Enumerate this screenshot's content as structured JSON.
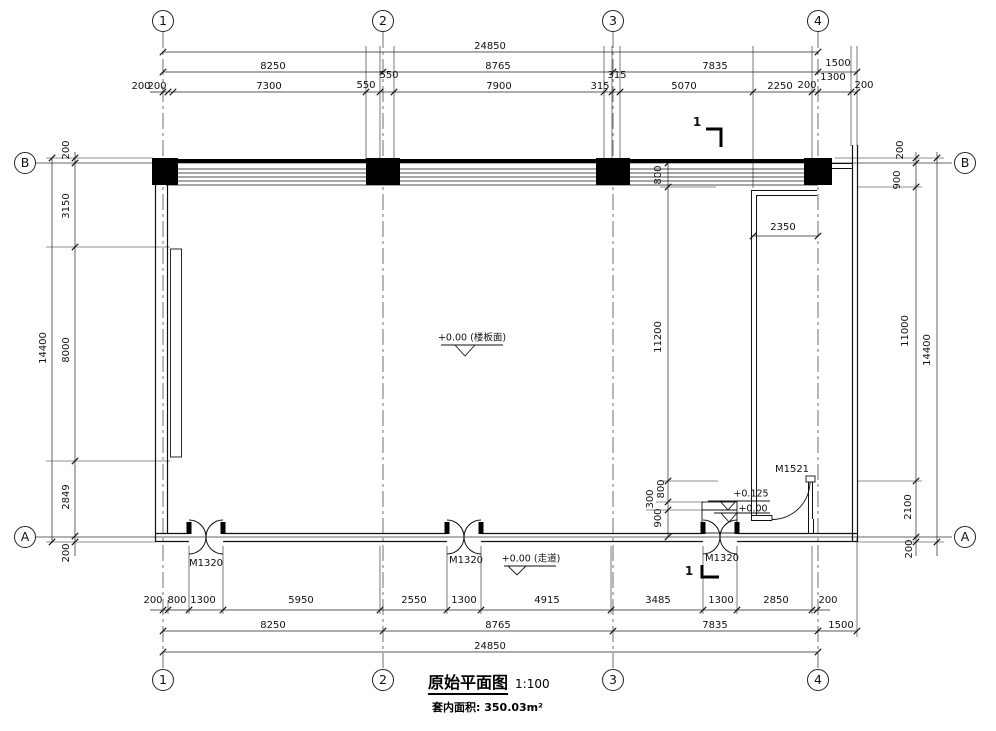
{
  "page": {
    "title": "原始平面图",
    "scale": "1:100",
    "area_note": "套内面积: 350.03m²"
  },
  "grid_bubbles": [
    {
      "label": "1",
      "x": 163,
      "y": 21
    },
    {
      "label": "2",
      "x": 383,
      "y": 21
    },
    {
      "label": "3",
      "x": 613,
      "y": 21
    },
    {
      "label": "4",
      "x": 818,
      "y": 21
    },
    {
      "label": "1",
      "x": 163,
      "y": 680
    },
    {
      "label": "2",
      "x": 383,
      "y": 680
    },
    {
      "label": "3",
      "x": 613,
      "y": 680
    },
    {
      "label": "4",
      "x": 818,
      "y": 680
    },
    {
      "label": "B",
      "x": 25,
      "y": 163
    },
    {
      "label": "A",
      "x": 25,
      "y": 537
    },
    {
      "label": "B",
      "x": 965,
      "y": 163
    },
    {
      "label": "A",
      "x": 965,
      "y": 537
    }
  ],
  "labels": [
    {
      "name": "dim-label",
      "text": "24850",
      "x": 490,
      "y": 47
    },
    {
      "name": "dim-label",
      "text": "8250",
      "x": 273,
      "y": 67
    },
    {
      "name": "dim-label",
      "text": "8765",
      "x": 498,
      "y": 67
    },
    {
      "name": "dim-label",
      "text": "7835",
      "x": 715,
      "y": 67
    },
    {
      "name": "dim-label",
      "text": "1500",
      "x": 838,
      "y": 64
    },
    {
      "name": "dim-label",
      "text": "1300",
      "x": 833,
      "y": 78
    },
    {
      "name": "dim-label",
      "text": "200",
      "x": 141,
      "y": 87
    },
    {
      "name": "dim-label",
      "text": "200",
      "x": 157,
      "y": 87
    },
    {
      "name": "dim-label",
      "text": "7300",
      "x": 269,
      "y": 87
    },
    {
      "name": "dim-label",
      "text": "550",
      "x": 366,
      "y": 86
    },
    {
      "name": "dim-label",
      "text": "550",
      "x": 389,
      "y": 76
    },
    {
      "name": "dim-label",
      "text": "7900",
      "x": 499,
      "y": 87
    },
    {
      "name": "dim-label",
      "text": "315",
      "x": 600,
      "y": 87
    },
    {
      "name": "dim-label",
      "text": "315",
      "x": 617,
      "y": 76
    },
    {
      "name": "dim-label",
      "text": "5070",
      "x": 684,
      "y": 87
    },
    {
      "name": "dim-label",
      "text": "2250",
      "x": 780,
      "y": 87
    },
    {
      "name": "dim-label",
      "text": "200",
      "x": 807,
      "y": 86
    },
    {
      "name": "dim-label",
      "text": "200",
      "x": 864,
      "y": 86
    },
    {
      "name": "dim-label",
      "text": "200",
      "x": 153,
      "y": 601
    },
    {
      "name": "dim-label",
      "text": "800",
      "x": 177,
      "y": 601
    },
    {
      "name": "dim-label",
      "text": "1300",
      "x": 203,
      "y": 601
    },
    {
      "name": "dim-label",
      "text": "5950",
      "x": 301,
      "y": 601
    },
    {
      "name": "dim-label",
      "text": "2550",
      "x": 414,
      "y": 601
    },
    {
      "name": "dim-label",
      "text": "1300",
      "x": 464,
      "y": 601
    },
    {
      "name": "dim-label",
      "text": "4915",
      "x": 547,
      "y": 601
    },
    {
      "name": "dim-label",
      "text": "3485",
      "x": 658,
      "y": 601
    },
    {
      "name": "dim-label",
      "text": "1300",
      "x": 721,
      "y": 601
    },
    {
      "name": "dim-label",
      "text": "2850",
      "x": 776,
      "y": 601
    },
    {
      "name": "dim-label",
      "text": "200",
      "x": 828,
      "y": 601
    },
    {
      "name": "dim-label",
      "text": "8250",
      "x": 273,
      "y": 626
    },
    {
      "name": "dim-label",
      "text": "8765",
      "x": 498,
      "y": 626
    },
    {
      "name": "dim-label",
      "text": "7835",
      "x": 715,
      "y": 626
    },
    {
      "name": "dim-label",
      "text": "1500",
      "x": 841,
      "y": 626
    },
    {
      "name": "dim-label",
      "text": "24850",
      "x": 490,
      "y": 647
    },
    {
      "name": "dim-label",
      "text": "200",
      "x": 67,
      "y": 150,
      "rot": 1
    },
    {
      "name": "dim-label",
      "text": "3150",
      "x": 67,
      "y": 206,
      "rot": 1
    },
    {
      "name": "dim-label",
      "text": "8000",
      "x": 67,
      "y": 350,
      "rot": 1
    },
    {
      "name": "dim-label",
      "text": "2849",
      "x": 67,
      "y": 497,
      "rot": 1
    },
    {
      "name": "dim-label",
      "text": "200",
      "x": 67,
      "y": 553,
      "rot": 1
    },
    {
      "name": "dim-label",
      "text": "14400",
      "x": 44,
      "y": 348,
      "rot": 1
    },
    {
      "name": "dim-label",
      "text": "200",
      "x": 901,
      "y": 150,
      "rot": 1
    },
    {
      "name": "dim-label",
      "text": "900",
      "x": 898,
      "y": 180,
      "rot": 1
    },
    {
      "name": "dim-label",
      "text": "11000",
      "x": 906,
      "y": 331,
      "rot": 1
    },
    {
      "name": "dim-label",
      "text": "14400",
      "x": 928,
      "y": 350,
      "rot": 1
    },
    {
      "name": "dim-label",
      "text": "2100",
      "x": 909,
      "y": 507,
      "rot": 1
    },
    {
      "name": "dim-label",
      "text": "200",
      "x": 910,
      "y": 549,
      "rot": 1
    },
    {
      "name": "dim-label",
      "text": "800",
      "x": 659,
      "y": 175,
      "rot": 1
    },
    {
      "name": "dim-label",
      "text": "11200",
      "x": 659,
      "y": 337,
      "rot": 1
    },
    {
      "name": "dim-label",
      "text": "2350",
      "x": 783,
      "y": 228
    },
    {
      "name": "dim-label",
      "text": "800",
      "x": 662,
      "y": 489,
      "rot": 1
    },
    {
      "name": "dim-label",
      "text": "300",
      "x": 651,
      "y": 499,
      "rot": 1
    },
    {
      "name": "dim-label",
      "text": "900",
      "x": 659,
      "y": 518,
      "rot": 1
    },
    {
      "name": "door-label",
      "text": "M1320",
      "x": 206,
      "y": 564
    },
    {
      "name": "door-label",
      "text": "M1320",
      "x": 466,
      "y": 561
    },
    {
      "name": "door-label",
      "text": "M1320",
      "x": 722,
      "y": 559
    },
    {
      "name": "door-label",
      "text": "M1521",
      "x": 792,
      "y": 470
    },
    {
      "name": "elevation-label",
      "text": "+0.00 (楼板面)",
      "x": 472,
      "y": 338,
      "cls": "elev"
    },
    {
      "name": "elevation-label",
      "text": "+0.00 (走道)",
      "x": 531,
      "y": 559,
      "cls": "elev"
    },
    {
      "name": "elevation-label",
      "text": "+0.125",
      "x": 751,
      "y": 494,
      "cls": "elev"
    },
    {
      "name": "elevation-label",
      "text": "+0.00",
      "x": 753,
      "y": 509,
      "cls": "elev"
    },
    {
      "name": "section-label",
      "text": "1",
      "x": 697,
      "y": 122,
      "cls": "sec"
    },
    {
      "name": "section-label",
      "text": "1",
      "x": 689,
      "y": 571,
      "cls": "sec"
    }
  ]
}
